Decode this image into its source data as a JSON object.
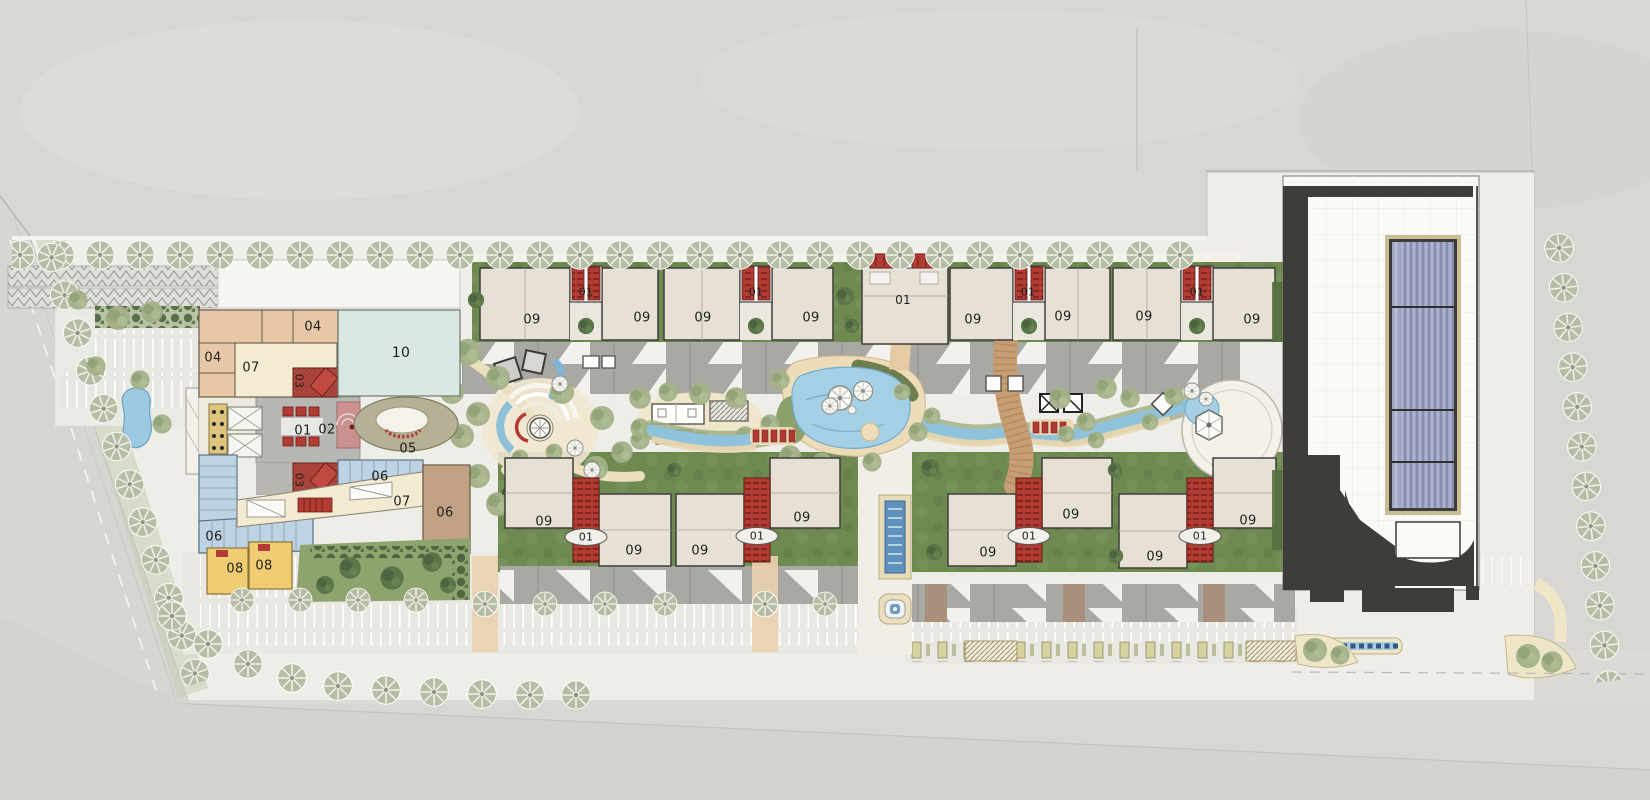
{
  "document": {
    "kind": "architectural-site-plan",
    "description": "Master plan: mixed-use podium (blocks 01-08, 10), two rows of residential blocks 09 with stair cores 01, central landscape spine with lagoon pools, and large retail building with linear skylight"
  },
  "palette": {
    "context_gray": "#d8d7d3",
    "site_ground": "#efede7",
    "asphalt": "#e9e8e3",
    "canopy_gray": "#a9a8a3",
    "residential_roof": "#e7e1d5",
    "core_red": "#b23c33",
    "green_band": "#6f8a51",
    "sage_tree": "#a3b188",
    "water_blue": "#a5cfe4",
    "pool_deep": "#5f93bd",
    "sand": "#ecdcb8",
    "mint_block10": "#d9e9e1",
    "tan_block": "#e6c8a6",
    "cream_block": "#f4ebd3",
    "blue_block06": "#bdd2e2",
    "yellow_block08": "#f0cd72",
    "olive_block05": "#b6b194",
    "charcoal": "#3e3d3a",
    "skylight_blue": "#9ba1c2",
    "boardwalk": "#c79e74"
  },
  "labels": [
    {
      "id": "b04-top",
      "text": "04",
      "x": 313,
      "y": 327,
      "size": 13,
      "rot": 0
    },
    {
      "id": "b04-left",
      "text": "04",
      "x": 213,
      "y": 358,
      "size": 13,
      "rot": 0
    },
    {
      "id": "b07-upper",
      "text": "07",
      "x": 251,
      "y": 368,
      "size": 13,
      "rot": 0
    },
    {
      "id": "b03-upper",
      "text": "03",
      "x": 299,
      "y": 381,
      "size": 11,
      "rot": 90
    },
    {
      "id": "b10",
      "text": "10",
      "x": 401,
      "y": 353,
      "size": 14,
      "rot": 0
    },
    {
      "id": "b01-plaza",
      "text": "01",
      "x": 303,
      "y": 431,
      "size": 13,
      "rot": 0
    },
    {
      "id": "b02",
      "text": "02",
      "x": 327,
      "y": 430,
      "size": 13,
      "rot": 0
    },
    {
      "id": "b05",
      "text": "05",
      "x": 408,
      "y": 449,
      "size": 13,
      "rot": 0
    },
    {
      "id": "b06-upper",
      "text": "06",
      "x": 380,
      "y": 477,
      "size": 13,
      "rot": 0
    },
    {
      "id": "b07-lower",
      "text": "07",
      "x": 402,
      "y": 502,
      "size": 13,
      "rot": 0
    },
    {
      "id": "b06-right",
      "text": "06",
      "x": 445,
      "y": 513,
      "size": 13,
      "rot": 0
    },
    {
      "id": "b06-left",
      "text": "06",
      "x": 214,
      "y": 537,
      "size": 13,
      "rot": 0
    },
    {
      "id": "b08-a",
      "text": "08",
      "x": 235,
      "y": 569,
      "size": 13,
      "rot": 0
    },
    {
      "id": "b08-b",
      "text": "08",
      "x": 264,
      "y": 566,
      "size": 13,
      "rot": 0
    },
    {
      "id": "b03-lower",
      "text": "03",
      "x": 299,
      "y": 480,
      "size": 11,
      "rot": 90
    },
    {
      "id": "t09-1",
      "text": "09",
      "x": 532,
      "y": 320,
      "size": 13,
      "rot": 0
    },
    {
      "id": "t01-1",
      "text": "01",
      "x": 586,
      "y": 292,
      "size": 11,
      "rot": 0
    },
    {
      "id": "t09-2",
      "text": "09",
      "x": 642,
      "y": 318,
      "size": 13,
      "rot": 0
    },
    {
      "id": "t09-3",
      "text": "09",
      "x": 703,
      "y": 318,
      "size": 13,
      "rot": 0
    },
    {
      "id": "t01-2",
      "text": "01",
      "x": 756,
      "y": 292,
      "size": 11,
      "rot": 0
    },
    {
      "id": "t09-4",
      "text": "09",
      "x": 811,
      "y": 318,
      "size": 13,
      "rot": 0
    },
    {
      "id": "t01-center",
      "text": "01",
      "x": 903,
      "y": 300,
      "size": 12,
      "rot": 0
    },
    {
      "id": "t09-5",
      "text": "09",
      "x": 973,
      "y": 320,
      "size": 13,
      "rot": 0
    },
    {
      "id": "t01-3",
      "text": "01",
      "x": 1028,
      "y": 292,
      "size": 11,
      "rot": 0
    },
    {
      "id": "t09-6",
      "text": "09",
      "x": 1063,
      "y": 317,
      "size": 13,
      "rot": 0
    },
    {
      "id": "t09-7",
      "text": "09",
      "x": 1144,
      "y": 317,
      "size": 13,
      "rot": 0
    },
    {
      "id": "t01-4",
      "text": "01",
      "x": 1197,
      "y": 292,
      "size": 11,
      "rot": 0
    },
    {
      "id": "t09-8",
      "text": "09",
      "x": 1252,
      "y": 320,
      "size": 13,
      "rot": 0
    },
    {
      "id": "s09-1",
      "text": "09",
      "x": 544,
      "y": 522,
      "size": 13,
      "rot": 0
    },
    {
      "id": "s01-1",
      "text": "01",
      "x": 586,
      "y": 537,
      "size": 11,
      "rot": 0
    },
    {
      "id": "s09-2",
      "text": "09",
      "x": 634,
      "y": 551,
      "size": 13,
      "rot": 0
    },
    {
      "id": "s09-3",
      "text": "09",
      "x": 700,
      "y": 551,
      "size": 13,
      "rot": 0
    },
    {
      "id": "s01-2",
      "text": "01",
      "x": 757,
      "y": 536,
      "size": 11,
      "rot": 0
    },
    {
      "id": "s09-4",
      "text": "09",
      "x": 802,
      "y": 518,
      "size": 13,
      "rot": 0
    },
    {
      "id": "s09-5",
      "text": "09",
      "x": 988,
      "y": 553,
      "size": 13,
      "rot": 0
    },
    {
      "id": "s01-3",
      "text": "01",
      "x": 1029,
      "y": 536,
      "size": 11,
      "rot": 0
    },
    {
      "id": "s09-6",
      "text": "09",
      "x": 1071,
      "y": 515,
      "size": 13,
      "rot": 0
    },
    {
      "id": "s09-7",
      "text": "09",
      "x": 1155,
      "y": 557,
      "size": 13,
      "rot": 0
    },
    {
      "id": "s01-4",
      "text": "01",
      "x": 1200,
      "y": 536,
      "size": 11,
      "rot": 0
    },
    {
      "id": "s09-8",
      "text": "09",
      "x": 1248,
      "y": 521,
      "size": 13,
      "rot": 0
    }
  ]
}
